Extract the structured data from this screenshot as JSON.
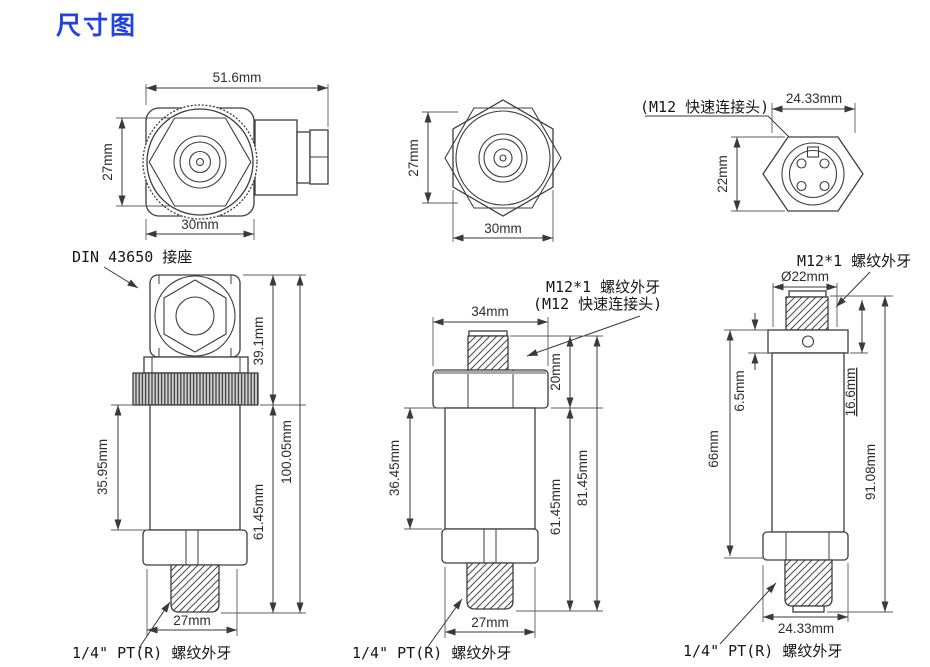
{
  "title": "尺寸图",
  "colors": {
    "title_accent": "#2243df",
    "line": "#3d3d3d"
  },
  "labels": {
    "din_socket": "DIN 43650 接座",
    "thread_quarter": "1/4\" PT(R) 螺纹外牙",
    "m12_thread": "M12*1 螺纹外牙",
    "m12_quick": "(M12 快速连接头)"
  },
  "din": {
    "top_width": "51.6mm",
    "top_height": "27mm",
    "top_hex": "30mm",
    "upper": "39.1mm",
    "total": "100.05mm",
    "body": "35.95mm",
    "lower": "61.45mm",
    "hex": "27mm"
  },
  "m12": {
    "top_height": "27mm",
    "top_hex": "30mm",
    "hex_width": "34mm",
    "conn_height": "20mm",
    "body": "36.45mm",
    "lower": "61.45mm",
    "total": "81.45mm",
    "hex": "27mm"
  },
  "m12c": {
    "top_width": "24.33mm",
    "top_height": "22mm",
    "dia": "Ø22mm",
    "collar": "6.5mm",
    "body": "66mm",
    "upper": "16.6mm",
    "total": "91.08mm",
    "hex": "24.33mm"
  }
}
